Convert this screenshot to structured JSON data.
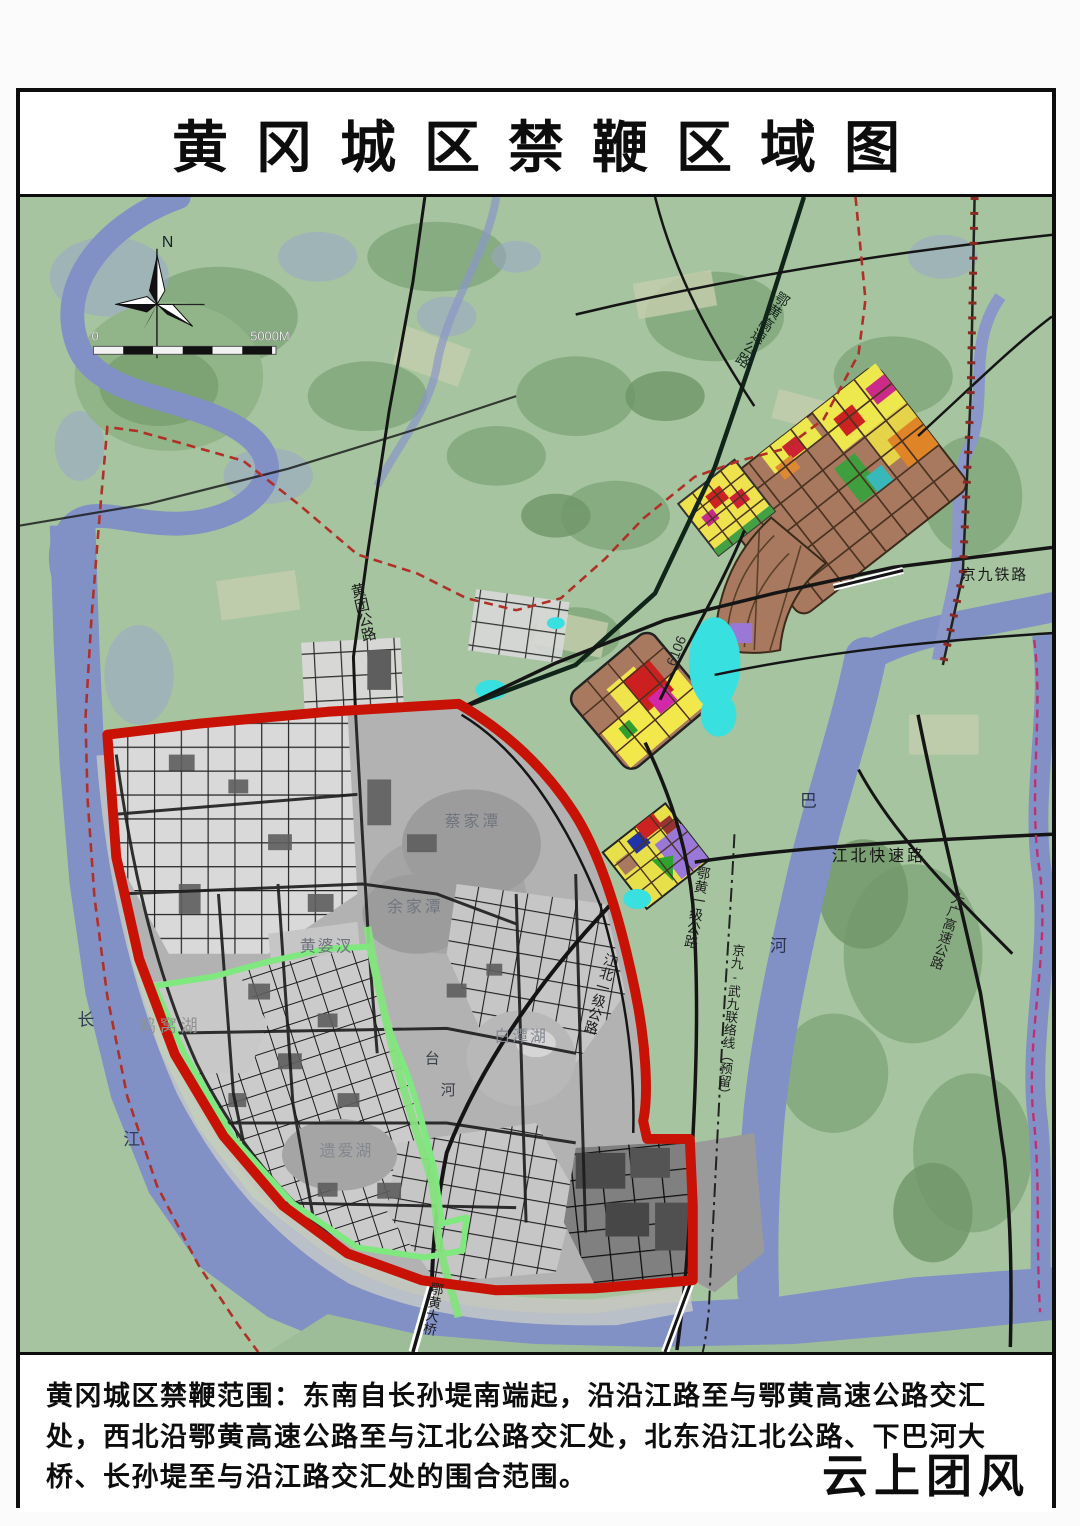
{
  "frame": {
    "title": "黄冈城区禁鞭区域图"
  },
  "map": {
    "compass_n": "N",
    "scale": {
      "start": "0",
      "end": "5000M"
    },
    "labels": [
      {
        "id": "huangtuan-road",
        "text": "黄团公路",
        "x": 338,
        "y": 388,
        "rot": -13,
        "vertical": true,
        "size": 15,
        "color": "#1c1c1c"
      },
      {
        "id": "ehuang-expressway",
        "text": "鄂黄高速公路",
        "x": 771,
        "y": 96,
        "rot": 33,
        "vertical": true,
        "size": 14.5,
        "color": "#13271c"
      },
      {
        "id": "jingjiu-railway",
        "text": "京九铁路",
        "x": 948,
        "y": 384,
        "size": 15,
        "color": "#1c1c1c",
        "spacing": 2
      },
      {
        "id": "road-6106",
        "text": "6106",
        "x": 660,
        "y": 472,
        "rot": -68,
        "size": 14,
        "color": "#2a2a2a"
      },
      {
        "id": "jiangbei-expressway",
        "text": "江北快速路",
        "x": 818,
        "y": 667,
        "size": 16,
        "color": "#141414",
        "spacing": 3
      },
      {
        "id": "ba-river-ba",
        "text": "巴",
        "x": 786,
        "y": 612,
        "size": 17,
        "color": "#2b3350"
      },
      {
        "id": "ba-river-he",
        "text": "河",
        "x": 756,
        "y": 758,
        "size": 17,
        "color": "#2b3350"
      },
      {
        "id": "ehuang-first-class-road",
        "text": "鄂黄一级公路",
        "x": 690,
        "y": 672,
        "rot": 10,
        "vertical": true,
        "size": 14,
        "color": "#1c1c1c"
      },
      {
        "id": "jingjiu-wujiu-link",
        "text": "京九-武九联络线（预留）",
        "x": 724,
        "y": 750,
        "rot": 6,
        "vertical": true,
        "size": 13,
        "color": "#1c1c1c"
      },
      {
        "id": "jiangbei-first-class-road",
        "text": "江北一级公路",
        "x": 597,
        "y": 760,
        "rot": 16,
        "vertical": true,
        "size": 14,
        "color": "#1c1c1c"
      },
      {
        "id": "daguang-expressway",
        "text": "大广高速公路",
        "x": 946,
        "y": 698,
        "rot": 18,
        "vertical": true,
        "size": 13.5,
        "color": "#222222"
      },
      {
        "id": "caijiatan-lake",
        "text": "蔡家潭",
        "x": 428,
        "y": 632,
        "size": 16,
        "color": "#70757f",
        "spacing": 3
      },
      {
        "id": "yujiatan-lake",
        "text": "余家潭",
        "x": 370,
        "y": 718,
        "size": 16,
        "color": "#70757f",
        "spacing": 3
      },
      {
        "id": "huangpocha-lake",
        "text": "黄婆汊",
        "x": 282,
        "y": 758,
        "size": 16,
        "color": "#6d727c",
        "spacing": 2
      },
      {
        "id": "baitanhu-lake",
        "text": "白潭湖",
        "x": 478,
        "y": 848,
        "size": 16,
        "color": "#83878f",
        "spacing": 2
      },
      {
        "id": "jiwohu-lake",
        "text": "鸡窝湖",
        "x": 120,
        "y": 838,
        "size": 17,
        "color": "#8f938f",
        "spacing": 4
      },
      {
        "id": "yiaihu-lake",
        "text": "遗爱湖",
        "x": 302,
        "y": 963,
        "size": 16,
        "color": "#83878f",
        "spacing": 2
      },
      {
        "id": "tai-river-tai",
        "text": "台",
        "x": 408,
        "y": 870,
        "size": 15,
        "color": "#3c4148"
      },
      {
        "id": "tai-river-he",
        "text": "河",
        "x": 424,
        "y": 902,
        "size": 15,
        "color": "#3c4148"
      },
      {
        "id": "ehuang-bridge",
        "text": "鄂黄大桥",
        "x": 420,
        "y": 1090,
        "rot": 10,
        "vertical": true,
        "size": 13.5,
        "color": "#1c1c1c"
      },
      {
        "id": "changjiang-chang",
        "text": "长",
        "x": 58,
        "y": 832,
        "size": 17,
        "color": "#333a55"
      },
      {
        "id": "changjiang-jiang",
        "text": "江",
        "x": 104,
        "y": 952,
        "size": 17,
        "color": "#333a55"
      }
    ]
  },
  "footer": {
    "description": "黄冈城区禁鞭范围：东南自长孙堤南端起，沿沿江路至与鄂黄高速公路交汇处，西北沿鄂黄高速公路至与江北公路交汇处，北东沿江北公路、下巴河大桥、长孙堤至与沿江路交汇处的围合范围。",
    "watermark": "云上团风"
  },
  "colors": {
    "ban_zone_red": "#c81205",
    "core_zone_green": "#7fe87f",
    "terrain_green": "#a5c49f",
    "water_blue": "#8190c5",
    "city_gray": "#b2b2b2",
    "boundary_dash_red": "#b03028",
    "planning_brown": "#a8795f"
  }
}
